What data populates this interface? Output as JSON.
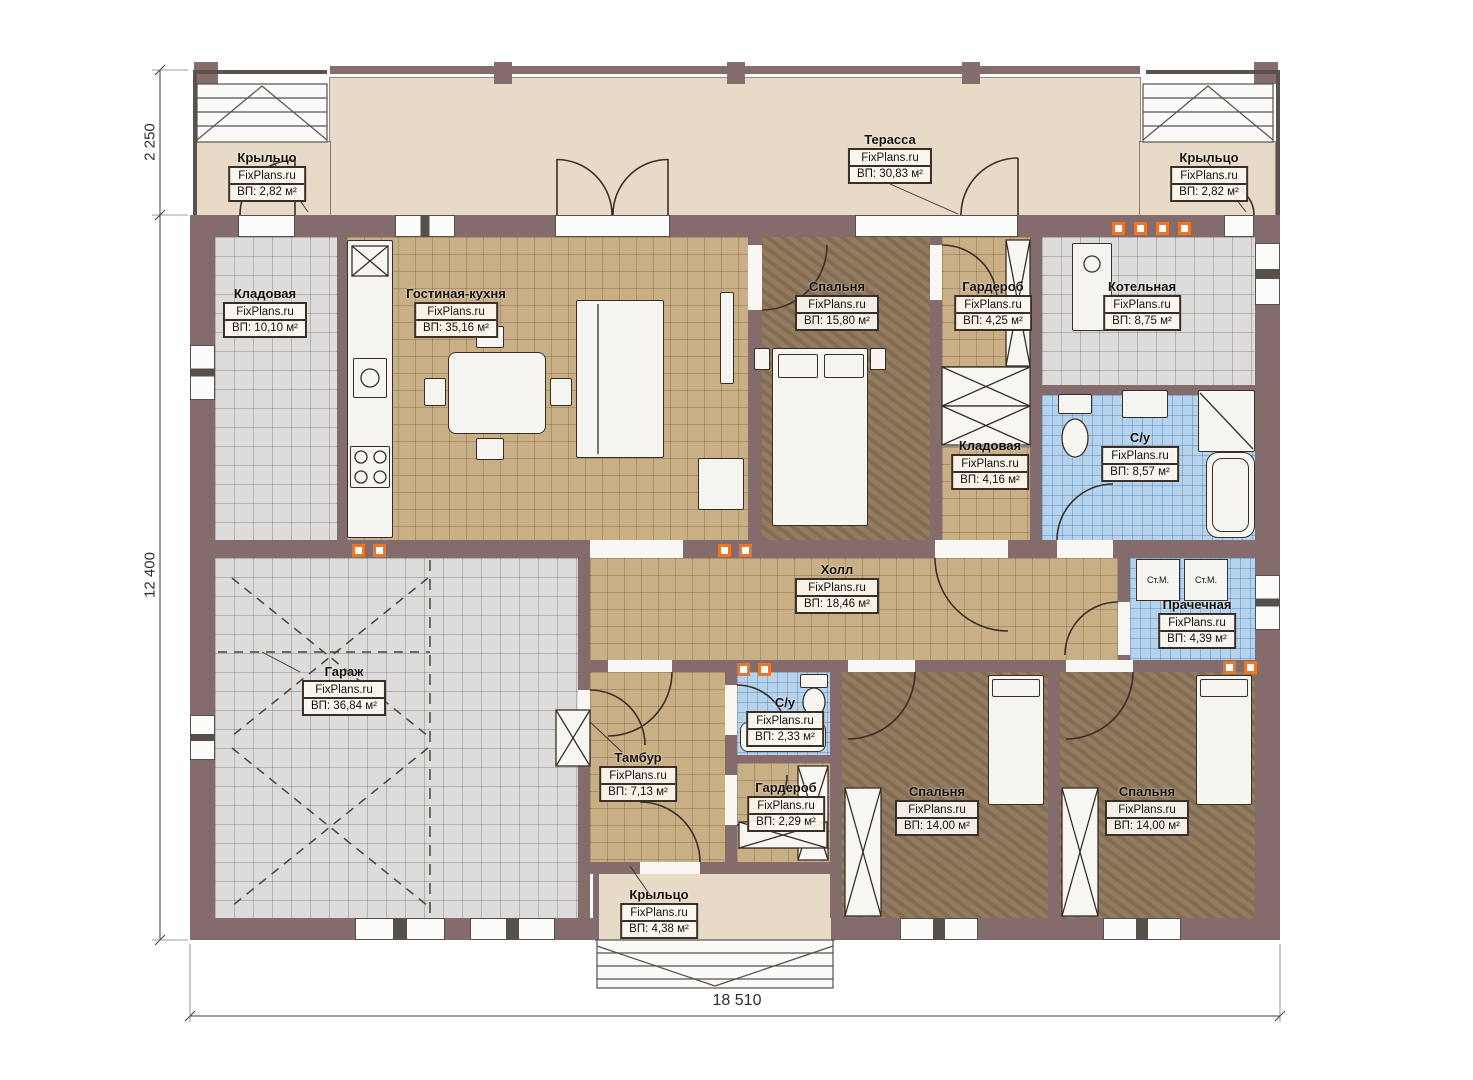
{
  "meta": {
    "brand": "FixPlans.ru"
  },
  "plan": {
    "dimensions": {
      "porch_depth_mm": "2 250",
      "house_depth_mm": "12 400",
      "house_width_mm": "18 510"
    },
    "appliances": {
      "washing_machine": "Ст.М."
    },
    "rooms": [
      {
        "key": "terrace",
        "name": "Терасса",
        "area": "ВП: 30,83 м²"
      },
      {
        "key": "porch_top_left",
        "name": "Крыльцо",
        "area": "ВП: 2,82 м²"
      },
      {
        "key": "porch_top_right",
        "name": "Крыльцо",
        "area": "ВП: 2,82 м²"
      },
      {
        "key": "pantry",
        "name": "Кладовая",
        "area": "ВП: 10,10 м²"
      },
      {
        "key": "living_kitchen",
        "name": "Гостиная-кухня",
        "area": "ВП: 35,16 м²"
      },
      {
        "key": "bedroom_master",
        "name": "Спальня",
        "area": "ВП: 15,80 м²"
      },
      {
        "key": "wardrobe",
        "name": "Гардероб",
        "area": "ВП: 4,25 м²"
      },
      {
        "key": "boiler_room",
        "name": "Котельная",
        "area": "ВП: 8,75 м²"
      },
      {
        "key": "pantry_small",
        "name": "Кладовая",
        "area": "ВП: 4,16 м²"
      },
      {
        "key": "bathroom_main",
        "name": "С/у",
        "area": "ВП: 8,57 м²"
      },
      {
        "key": "hall",
        "name": "Холл",
        "area": "ВП: 18,46 м²"
      },
      {
        "key": "laundry",
        "name": "Прачечная",
        "area": "ВП: 4,39 м²"
      },
      {
        "key": "garage",
        "name": "Гараж",
        "area": "ВП: 36,84 м²"
      },
      {
        "key": "vestibule",
        "name": "Тамбур",
        "area": "ВП: 7,13 м²"
      },
      {
        "key": "bathroom_small",
        "name": "С/у",
        "area": "ВП: 2,33 м²"
      },
      {
        "key": "wardrobe_small",
        "name": "Гардероб",
        "area": "ВП: 2,29 м²"
      },
      {
        "key": "bedroom_left",
        "name": "Спальня",
        "area": "ВП: 14,00 м²"
      },
      {
        "key": "bedroom_right",
        "name": "Спальня",
        "area": "ВП: 14,00 м²"
      },
      {
        "key": "porch_bottom",
        "name": "Крыльцо",
        "area": "ВП: 4,38 м²"
      }
    ],
    "colors": {
      "wall": "#846c6c",
      "terrace_floor": "#e7dbc7",
      "tile_warm": "#c9af86",
      "tile_gray": "#dddcda",
      "tile_blue": "#b6d3ee",
      "bedroom_floor": "#8c7458",
      "vent_marker": "#e8772c",
      "label_border": "#3b2e26",
      "linework": "#3a2f26"
    }
  }
}
